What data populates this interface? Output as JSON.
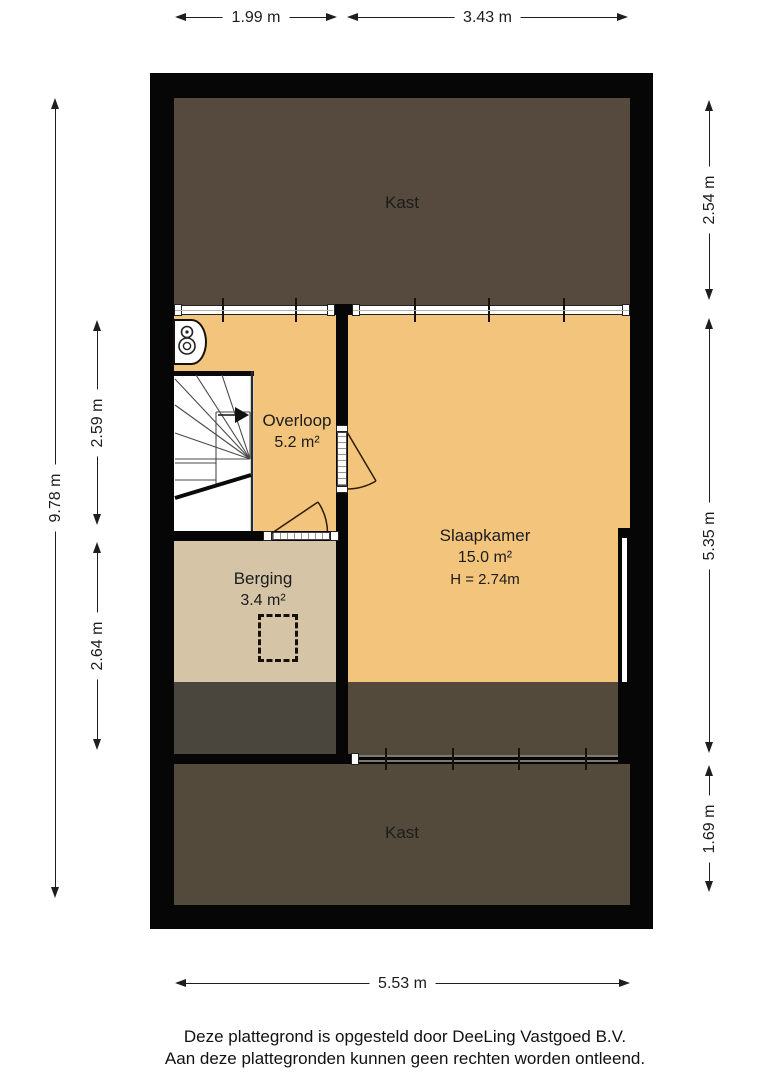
{
  "colors": {
    "wall": "#060606",
    "closet_top": "#564a3e",
    "floor_orange": "#f2c47c",
    "floor_beige": "#d5c4a5",
    "floor_dark_left": "#4a463e",
    "floor_dark_right": "#544a3b",
    "line_white": "#ffffff",
    "text": "#1c1c1c"
  },
  "rooms": {
    "kast_top": {
      "label": "Kast"
    },
    "overloop": {
      "label": "Overloop",
      "area": "5.2 m²"
    },
    "slaapkamer": {
      "label": "Slaapkamer",
      "area": "15.0 m²",
      "ceiling_height": "H = 2.74m"
    },
    "berging": {
      "label": "Berging",
      "area": "3.4 m²"
    },
    "kast_bottom": {
      "label": "Kast"
    }
  },
  "dimensions": {
    "top_left": "1.99 m",
    "top_right": "3.43 m",
    "left_total": "9.78 m",
    "left_upper": "2.59 m",
    "left_lower": "2.64 m",
    "right_upper": "2.54 m",
    "right_middle": "5.35 m",
    "right_lower": "1.69 m",
    "bottom_total": "5.53 m"
  },
  "footer": {
    "line1": "Deze plattegrond is opgesteld door DeeLing Vastgoed B.V.",
    "line2": "Aan deze plattegronden kunnen geen rechten worden ontleend."
  }
}
